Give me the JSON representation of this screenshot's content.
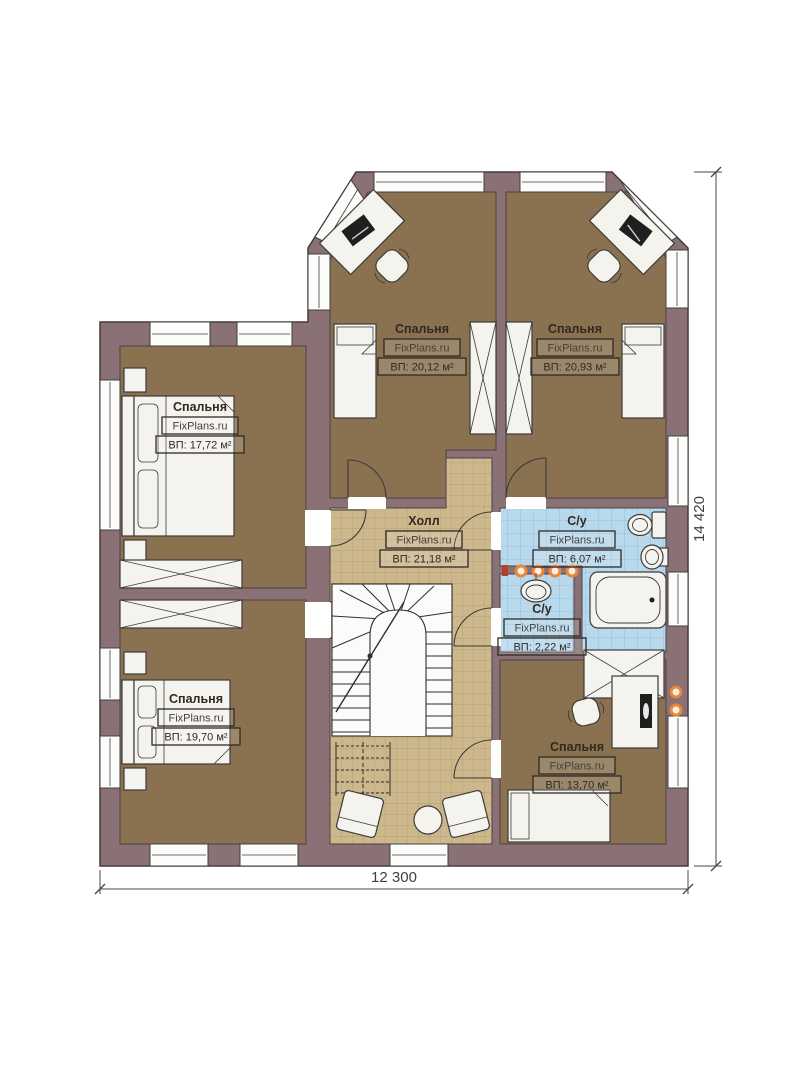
{
  "plan": {
    "watermark": "FixPlans.ru",
    "rooms": [
      {
        "id": "bedroom-top-left",
        "name": "Спальня",
        "area": "ВП: 20,12 м²"
      },
      {
        "id": "bedroom-top-right",
        "name": "Спальня",
        "area": "ВП: 20,93 м²"
      },
      {
        "id": "bedroom-left",
        "name": "Спальня",
        "area": "ВП: 17,72 м²"
      },
      {
        "id": "hall",
        "name": "Холл",
        "area": "ВП: 21,18 м²"
      },
      {
        "id": "bathroom",
        "name": "С/у",
        "area": "ВП: 6,07 м²"
      },
      {
        "id": "bathroom-small",
        "name": "С/у",
        "area": "ВП: 2,22 м²"
      },
      {
        "id": "bedroom-bottom-left",
        "name": "Спальня",
        "area": "ВП: 19,70 м²"
      },
      {
        "id": "bedroom-bottom-right",
        "name": "Спальня",
        "area": "ВП: 13,70 м²"
      }
    ],
    "dimensions": {
      "bottom": "12 300",
      "right": "14 420"
    },
    "furniture_symbols": [
      "single-bed",
      "double-bed",
      "desk",
      "office-chair",
      "wardrobe",
      "toilet",
      "sink",
      "bathtub",
      "staircase",
      "armchair",
      "round-table",
      "ceiling-spotlight",
      "wall-lamp",
      "door",
      "window"
    ],
    "colors": {
      "wall": "#8a7175",
      "bedroom_floor": "#8a7251",
      "hall_floor": "#cdb78c",
      "bath_floor": "#b8d9ec",
      "furniture": "#f4f3ee",
      "light_accent": "#e8873b",
      "background": "#ffffff"
    }
  }
}
